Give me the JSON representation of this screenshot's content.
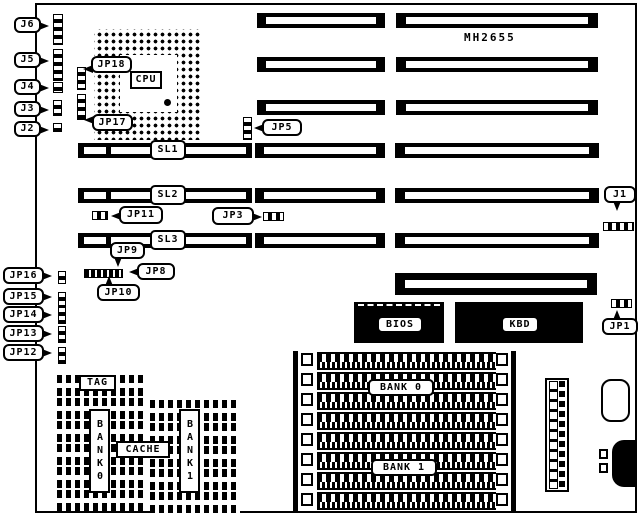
{
  "diagram": {
    "model": "MH2655",
    "colors": {
      "ink": "#000000",
      "paper": "#ffffff"
    }
  },
  "labels": {
    "model": "MH2655",
    "j6": "J6",
    "j5": "J5",
    "j4": "J4",
    "j3": "J3",
    "j2": "J2",
    "jp18": "JP18",
    "jp17": "JP17",
    "cpu": "CPU",
    "jp5": "JP5",
    "sl1": "SL1",
    "sl2": "SL2",
    "sl3": "SL3",
    "jp11": "JP11",
    "jp3": "JP3",
    "jp9": "JP9",
    "jp8": "JP8",
    "jp10": "JP10",
    "jp16": "JP16",
    "jp15": "JP15",
    "jp14": "JP14",
    "jp13": "JP13",
    "jp12": "JP12",
    "j1": "J1",
    "jp1": "JP1",
    "bios": "BIOS",
    "kbd": "KBD",
    "tag": "TAG",
    "cache": "CACHE",
    "cache_bank0": "BANK0",
    "cache_bank1": "BANK1",
    "bank0": "BANK 0",
    "bank1": "BANK 1"
  }
}
